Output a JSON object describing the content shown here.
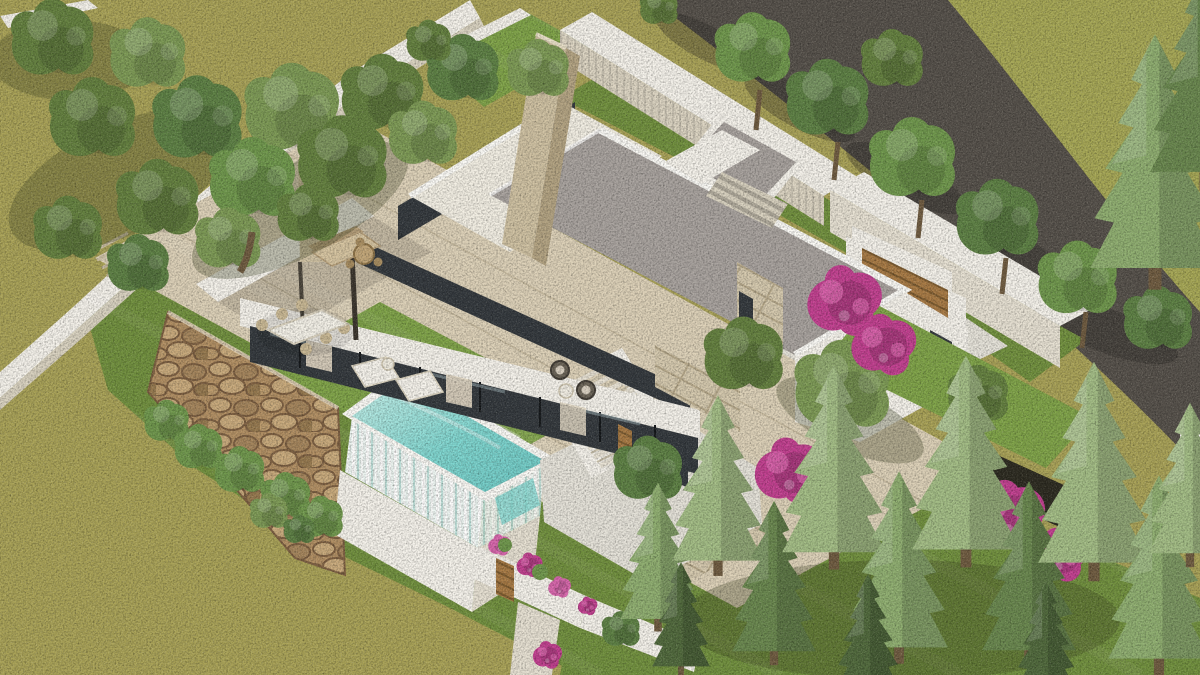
{
  "scene": {
    "type": "aerial-3d-architectural-render",
    "subject": "Modern two-storey white villa with flat gravel roofs, raised infinity pool, landscaped garden, driveway and wooden garage door beside an asphalt road",
    "view": "high-angle aerial isometric render",
    "setting": "hillside plot with olive-green meadow, mature trees, pale conifers and magenta bougainvillea"
  },
  "palette": {
    "field": "#a9a257",
    "fieldDark": "#8e8c46",
    "lawn": "#71903e",
    "lawnBright": "#7fa348",
    "lawnDark": "#5c7a33",
    "verge": "#a6a755",
    "road": "#55504a",
    "roadShadow": "#241f1b",
    "white": "#f6f3ec",
    "whiteShade": "#e7e1d3",
    "whiteShade2": "#d9d2c0",
    "fascia": "#fcfbf7",
    "whiteRoof": "#f3efe4",
    "gravel": "#a8a29e",
    "gravelDark": "#938d89",
    "travertine": "#cfc1a2",
    "travertineDark": "#b3a382",
    "terrace": "#ddd1b8",
    "terraceLine": "#b7a98c",
    "concrete": "#e6e3da",
    "wallBeige": "#ddd5c3",
    "glass": "#33383d",
    "glassLight": "#9fb2b8",
    "curtain": "#e3d8c4",
    "wood": "#a87a44",
    "woodDark": "#7c5a2e",
    "stoneBase": "#b28f63",
    "stoneDark": "#7d5f41",
    "stoneLight": "#c9aa7c",
    "limestone": "#d5c9ae",
    "limestoneLine": "#b6a88a",
    "poolWater": "#7fd6d0",
    "poolWaterLight": "#c8f0ea",
    "poolFallBase": "#eef6f3",
    "poolFallStreak": "#bfe0da",
    "treeOlive": "#64803f",
    "treeOliveLight": "#7d9a55",
    "treeGreen": "#5d8044",
    "treeBright": "#6f974c",
    "conifer": "#8fae70",
    "coniferPale": "#a3bd85",
    "coniferDark": "#69874e",
    "coniferDeep": "#50693c",
    "bougainvillea": "#c23f90",
    "bougainvilleaLight": "#da67ae",
    "trunk": "#6f5b40",
    "shadow": "#39421f"
  },
  "elements": {
    "road": {
      "label": "asphalt road with tree shadows"
    },
    "villa": {
      "label": "white modern villa with gray gravel flat roofs"
    },
    "pool": {
      "label": "raised turquoise infinity pool with waterfall edges"
    },
    "garage": {
      "label": "garage court with horizontal wood door"
    },
    "terrace": {
      "label": "travertine terrace with outdoor furniture"
    },
    "stoneWall": {
      "label": "rustic stone retaining wall"
    },
    "meadow": {
      "label": "olive green meadow"
    },
    "gardens": {
      "label": "mown lawns with shrubs, conifers and bougainvillea"
    }
  }
}
